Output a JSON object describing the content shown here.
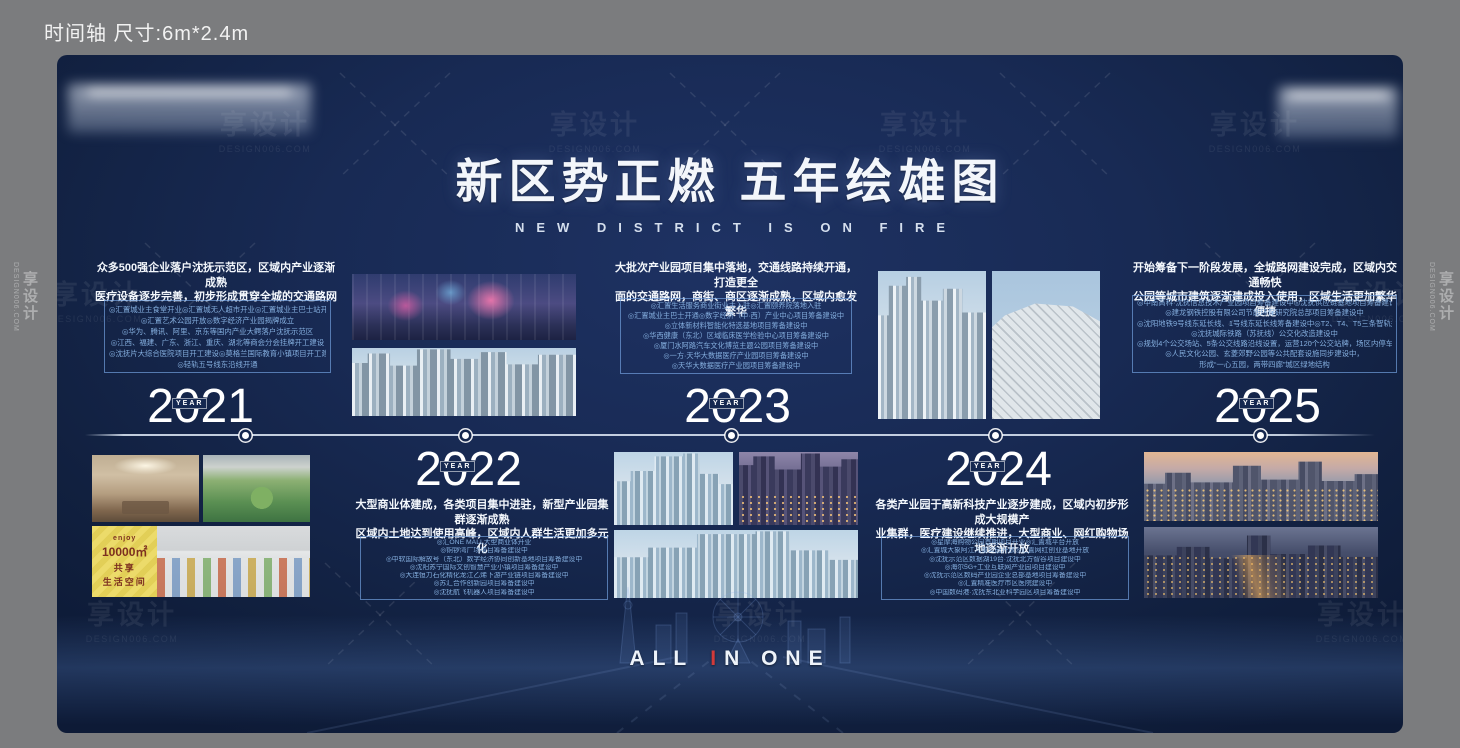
{
  "header": {
    "note": "时间轴 尺寸:6m*2.4m"
  },
  "watermark": {
    "brand": "享设计",
    "site": "DESIGN006.COM"
  },
  "poster": {
    "title": "新区势正燃 五年绘雄图",
    "subtitle": "NEW DISTRICT IS ON FIRE",
    "year_label": "YEAR",
    "slogan": {
      "left": "ALL",
      "accent": "I",
      "right": "N ONE"
    },
    "colors": {
      "board_navy": "#15264c",
      "box_border": "#709edc",
      "box_text": "#84aede",
      "accent_red": "#d23a3a"
    },
    "market_poster": {
      "brand": "enjoy",
      "big": "10000㎡",
      "l1": "共享",
      "l2": "生活空间"
    },
    "sections": {
      "y2021": {
        "year": "2021",
        "headline1": "众多500强企业落户沈抚示范区，区域内产业逐渐成熟",
        "headline2": "医疗设备逐步完善，初步形成贯穿全城的交通路网",
        "bullets": [
          "◎汇置城业主食堂开业◎汇置城无人超市开业◎汇置城业主巴士站开通",
          "◎汇置艺术公园开放◎数字经济产业园揭牌成立",
          "◎华为、腾讯、阿里、京东等国内产业大鳄落户沈抚示范区",
          "◎江西、福建、广东、浙江、重庆、湖北等商会分会挂牌开工建设",
          "◎沈抚片大综合医院项目开工建设◎莫格兰国际教育小镇项目开工建设",
          "◎轻轨五号线东沿线开通"
        ]
      },
      "y2022": {
        "year": "2022",
        "headline1": "大型商业体建成，各类项目集中进驻，新型产业园集群逐渐成熟",
        "headline2": "区域内土地达到使用高峰，区域内人群生活更加多元化",
        "bullets": [
          "◎汇ONE MALL大型商业体开业",
          "◎铜锣湾广场项目筹备建设中",
          "◎中软国际解放号（东北）数字经济协同创新基地项目筹备建设中",
          "◎沈阳苏宁国际文创智慧产业小镇项目筹备建设中",
          "◎大连恒力石化精化龙江乙烯下游产业链项目筹备建设中",
          "◎苏汇合作创新园项目筹备建设中",
          "◎沈抚航飞机器人项目筹备建设中"
        ]
      },
      "y2023": {
        "year": "2023",
        "headline1": "大批次产业园项目集中落地，交通线路持续开通，打造更全",
        "headline2": "面的交通路网，商街、商区逐渐成熟，区域内愈发繁华",
        "bullets": [
          "◎汇置生活服务商业街业主入驻◎汇置颐养院落地入驻",
          "◎汇置城业主巴士开通◎数字经济（中·西）产业中心项目筹备建设中",
          "◎立体新材料智能化特选基地项目筹备建设中",
          "◎华西健康（东北）区域临床医学检验中心项目筹备建设中",
          "◎厦门水阿路汽车文化博览主题公园项目筹备建设中",
          "◎一方·天华大数据医疗产业园项目筹备建设中",
          "◎天华大数据医疗产业园项目筹备建设中"
        ]
      },
      "y2024": {
        "year": "2024",
        "headline1": "各类产业园于高新科技产业逐步建成，区域内初步形成大规模产",
        "headline2": "业集群，医疗建设继续推进，大型商业、网红购物场地逐渐开放",
        "bullets": [
          "◎星摩海购物公园首期项目开业◎汇置城平台开放",
          "◎汇置城大象阿江儿童公园开放◎汇置网红创业基地开放",
          "◎沈抚示范区数据湖19台·沈抚北方智谷项目建设中",
          "◎海尔5G+工业互联网产业园项目建设中",
          "◎沈抚示范区数码产业园企业总部基地项目筹备建设中",
          "◎汇置精准医疗市区医院建设中",
          "◎中国数码港·沈抚东北亚科学园区项目筹备建设中"
        ]
      },
      "y2025": {
        "year": "2025",
        "headline1": "开始筹备下一阶段发展，全城路网建设完成，区域内交通畅快",
        "headline2": "公园等城市建筑逐渐建成投入使用，区域生活更加繁华便捷",
        "bullets": [
          "◎中南高科·沈抚信息技术产业园项目筹备建设中◎沈抚供应链基地项目筹备建设中",
          "◎建龙钢铁控股有限公司节能环保研究院总部项目筹备建设中",
          "◎沈阳地铁9号线东延长线、1号线东延长线筹备建设中◎T2、T4、T5三条智轨规划中",
          "◎沈抚城际铁路（苏抚线）公交化改造建设中",
          "◎规划4个公交场站、5条公交线路沿线设置，运营120个公交站牌，场区内停车泊位170个",
          "◎人民文化公园、玄菱郊野公园等公共配套设施同步建设中，",
          "形成“一心五园，两带四廊”城区绿地结构"
        ]
      }
    }
  }
}
